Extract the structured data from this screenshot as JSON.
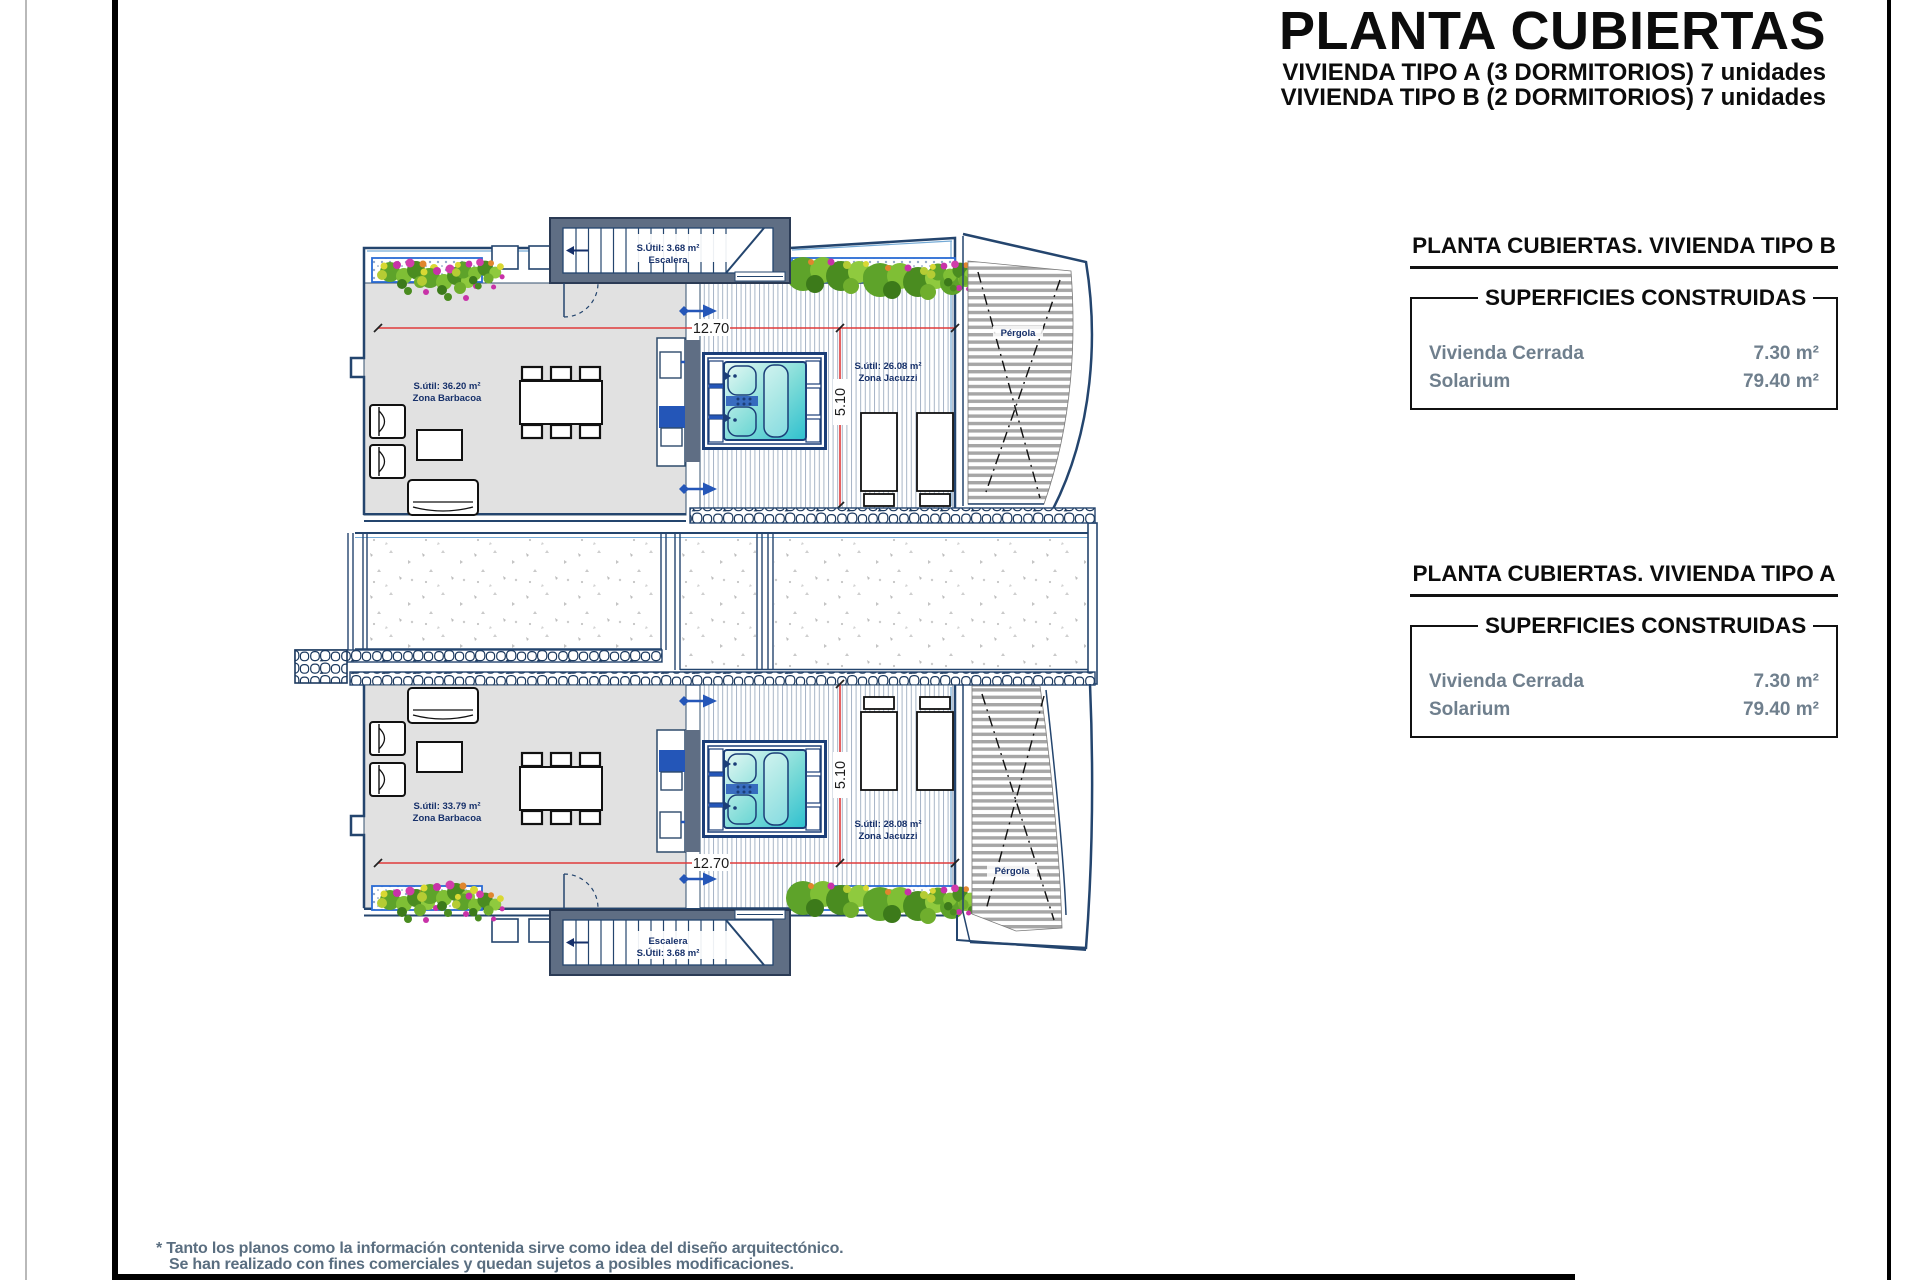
{
  "header": {
    "title": "PLANTA CUBIERTAS",
    "subtitle_a": "VIVIENDA TIPO A (3 DORMITORIOS) 7 unidades",
    "subtitle_b": "VIVIENDA TIPO B (2 DORMITORIOS) 7 unidades"
  },
  "summary_boxes": [
    {
      "heading": "PLANTA CUBIERTAS. VIVIENDA TIPO B",
      "table_title": "SUPERFICIES CONSTRUIDAS",
      "rows": [
        {
          "label": "Vivienda Cerrada",
          "value": "7.30 m²"
        },
        {
          "label": "Solarium",
          "value": "79.40 m²"
        }
      ]
    },
    {
      "heading": "PLANTA CUBIERTAS. VIVIENDA TIPO A",
      "table_title": "SUPERFICIES CONSTRUIDAS",
      "rows": [
        {
          "label": "Vivienda Cerrada",
          "value": "7.30 m²"
        },
        {
          "label": "Solarium",
          "value": "79.40 m²"
        }
      ]
    }
  ],
  "plan": {
    "upper_unit": {
      "stair_area": "S.Útil: 3.68 m²",
      "stair_name": "Escalera",
      "barbacoa_area": "S.útil: 36.20 m²",
      "barbacoa_name": "Zona Barbacoa",
      "jacuzzi_area": "S.útil: 26.08 m²",
      "jacuzzi_name": "Zona Jacuzzi",
      "pergola": "Pérgola",
      "dim_width": "12.70",
      "dim_depth": "5.10"
    },
    "lower_unit": {
      "stair_area": "S.Útil: 3.68 m²",
      "stair_name": "Escalera",
      "barbacoa_area": "S.útil: 33.79 m²",
      "barbacoa_name": "Zona Barbacoa",
      "jacuzzi_area": "S.útil: 28.08 m²",
      "jacuzzi_name": "Zona Jacuzzi",
      "pergola": "Pérgola",
      "dim_width": "12.70",
      "dim_depth": "5.10"
    }
  },
  "footnote": {
    "line1": "* Tanto los planos como la información contenida sirve como idea del diseño arquitectónico.",
    "line2": "Se han realizado con fines comerciales y quedan sujetos a posibles modificaciones."
  },
  "colors": {
    "wall_line": "#24456e",
    "wall_fill": "#5f6e84",
    "accent_blue": "#2456b8",
    "dimension_red": "#e03b3b",
    "floor_gray": "#e1e1e1",
    "pool_turquoise": "#2fc0cf"
  }
}
